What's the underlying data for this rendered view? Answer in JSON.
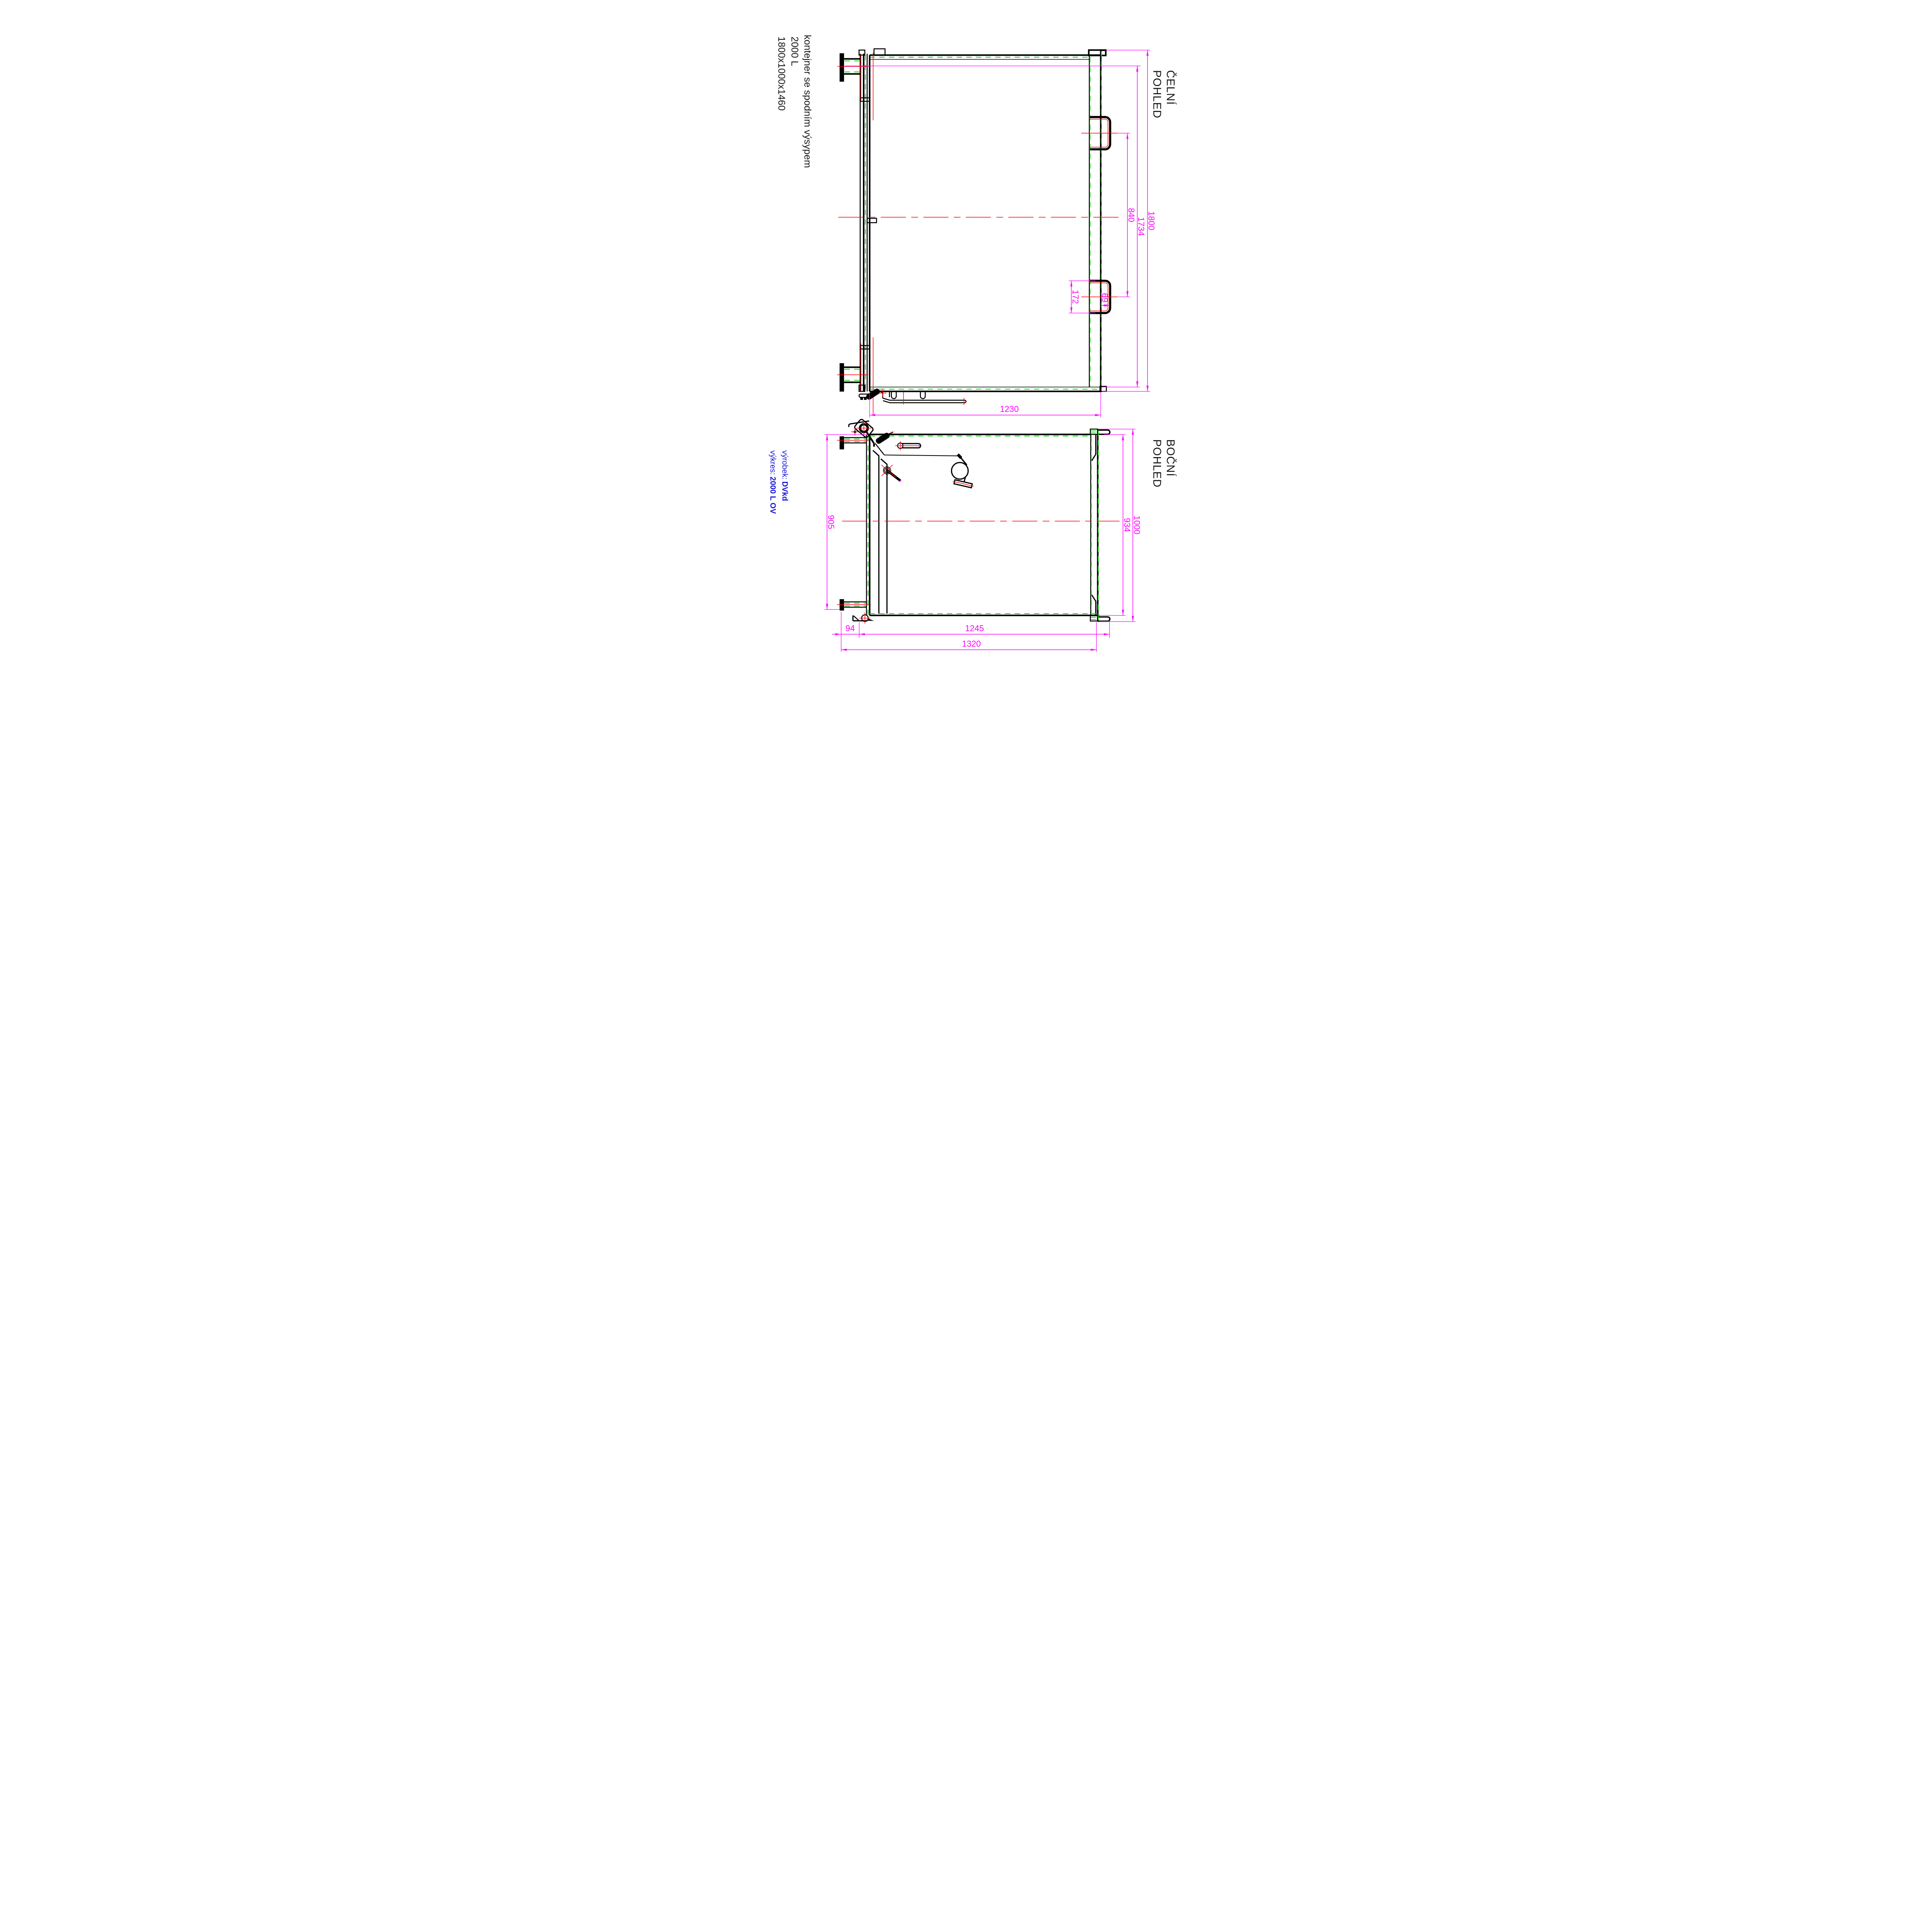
{
  "title": {
    "line1": "kontejner se spodním výsypem",
    "line2": "2000 L",
    "line3": "1800x1000x1460"
  },
  "views": {
    "front": {
      "label_line1": "ČELNÍ",
      "label_line2": "POHLED"
    },
    "side": {
      "label_line1": "BOČNÍ",
      "label_line2": "POHLED"
    }
  },
  "annotations": {
    "product_label": "výrobek:",
    "product_value": "DVkd",
    "drawing_label": "výkres:",
    "drawing_value": "2000 L OV"
  },
  "dims": {
    "front": {
      "overall_height": "1800",
      "trunnion_to_bottom": "1734",
      "handle_spacing": "840",
      "handle_height": "172",
      "handle_depth": "69",
      "width": "1230"
    },
    "side": {
      "interior_height": "905",
      "body_height": "934",
      "overall_height": "1000",
      "flap_offset": "94",
      "body_width": "1245",
      "overall_width": "1320"
    }
  },
  "colors": {
    "dimension": "#FF00FF",
    "centerline": "#FF0000",
    "hidden": "#00DC00",
    "annotation": "#1414DC",
    "outline": "#000000"
  }
}
